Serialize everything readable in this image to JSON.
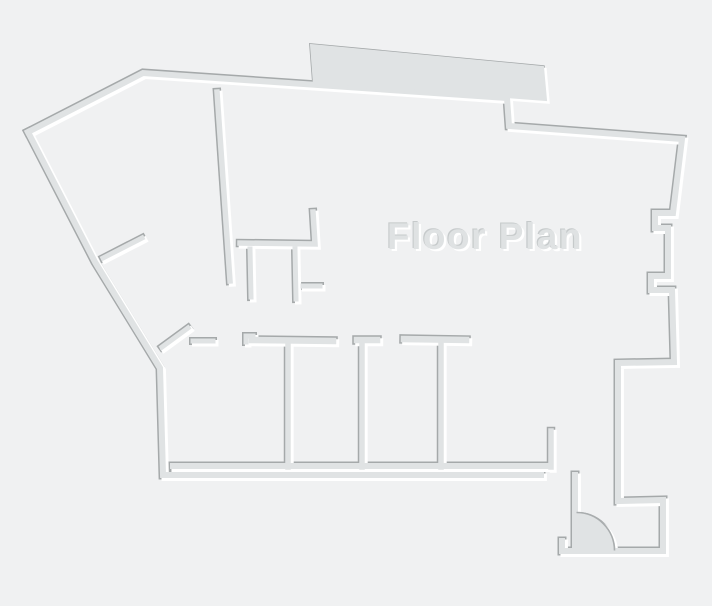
{
  "title": {
    "label": "Floor Plan"
  },
  "canvas": {
    "width": 712,
    "height": 606,
    "background": "#f0f1f2"
  },
  "palette": {
    "background": "#f0f1f2",
    "wall_core": "#e0e3e4",
    "wall_shadow": "#a5a9aa",
    "wall_highlight": "#ffffff",
    "door_arc_stroke": "#a9adae",
    "text_fill": "#dfe2e3",
    "text_shadow_dark": "#c6cacb",
    "text_highlight": "#ffffff"
  },
  "floorplan": {
    "label": {
      "text": "Floor Plan",
      "x": 485,
      "y": 249,
      "size": 37
    },
    "strokes": [
      {
        "name": "exterior-top-right-porch",
        "w": 6.0,
        "d": "M28,132 L143,73 L507,98 L509,126 L682,139 L673,213 L655,213 L655,228 L668,228 L668,276 L651,276 L651,290 L672,290 L674,362 L618,363 L618,501 L663,500 L663,551 L562,551 L562,541"
      },
      {
        "name": "door-hinge-wall",
        "w": 6.0,
        "d": "M575,551 L575,475"
      },
      {
        "name": "exterior-bottom-left",
        "w": 6.0,
        "d": "M541,475 L163,475 L160,368 L95,262 L28,132"
      },
      {
        "name": "tall-interior-wall",
        "w": 5.5,
        "d": "M217,92 L230,281"
      },
      {
        "name": "mid-room-wall",
        "w": 5.5,
        "d": "M313,212 L315,244 L240,243"
      },
      {
        "name": "mid-stub-a",
        "w": 5.0,
        "d": "M250,249 L251,297"
      },
      {
        "name": "mid-stub-b",
        "w": 5.0,
        "d": "M295,249 L296,299"
      },
      {
        "name": "mid-branch",
        "w": 5.0,
        "d": "M303,286 L320,286"
      },
      {
        "name": "rooms-inner-bottom-wall",
        "w": 6.0,
        "d": "M173,466 L548,466"
      },
      {
        "name": "rooms-right-stub",
        "w": 5.5,
        "d": "M551,431 L551,467"
      },
      {
        "name": "room-divider-1",
        "w": 5.5,
        "d": "M288,342 L288,467"
      },
      {
        "name": "room-divider-2",
        "w": 5.5,
        "d": "M362,341 L362,467"
      },
      {
        "name": "room-divider-3",
        "w": 5.5,
        "d": "M441,340 L441,467"
      },
      {
        "name": "room1-top-bar",
        "w": 6.5,
        "d": "M252,340 L333,341"
      },
      {
        "name": "room1-jamb-step",
        "w": 5.0,
        "d": "M246,342 L246,336 L253,336"
      },
      {
        "name": "room2-top-bar",
        "w": 6.5,
        "d": "M357,340 L377,340"
      },
      {
        "name": "room3-top-bar",
        "w": 6.5,
        "d": "M404,339 L466,340"
      },
      {
        "name": "west-stub",
        "w": 5.0,
        "d": "M193,341 L213,341"
      },
      {
        "name": "diag-stub-1",
        "w": 5.0,
        "d": "M103,258 L142,238"
      },
      {
        "name": "diag-stub-2",
        "w": 5.0,
        "d": "M162,347 L188,328"
      }
    ],
    "fills": [
      {
        "name": "top-band-slab",
        "w": 2.0,
        "d": "M311,45 L543,67 L546,100 L507,97 L314,84 Z"
      },
      {
        "name": "door-leaf-sector",
        "w": 1.0,
        "d": "M577,513 A38,38 0 0 1 615,551 L577,551 Z"
      }
    ],
    "door_arc": {
      "d": "M577,513 A38,38 0 0 1 615,551",
      "w": 1.6
    }
  }
}
